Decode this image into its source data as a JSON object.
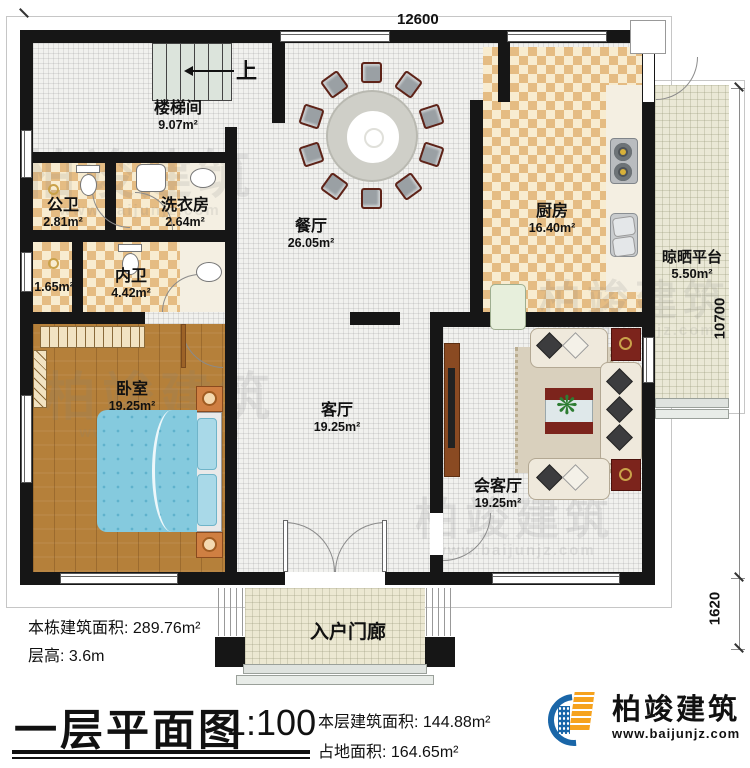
{
  "dimensions": {
    "top": "12600",
    "right": "10700",
    "bottom_right": "1620"
  },
  "stairs": {
    "up_label": "上"
  },
  "rooms": {
    "stairwell": {
      "name": "楼梯间",
      "area": "9.07m²"
    },
    "public_wc": {
      "name": "公卫",
      "area": "2.81m²"
    },
    "laundry": {
      "name": "洗衣房",
      "area": "2.64m²"
    },
    "closet": {
      "area": "1.65m²"
    },
    "private_wc": {
      "name": "内卫",
      "area": "4.42m²"
    },
    "bedroom": {
      "name": "卧室",
      "area": "19.25m²"
    },
    "dining": {
      "name": "餐厅",
      "area": "26.05m²"
    },
    "living": {
      "name": "客厅",
      "area": "19.25m²"
    },
    "kitchen": {
      "name": "厨房",
      "area": "16.40m²"
    },
    "reception": {
      "name": "会客厅",
      "area": "19.25m²"
    },
    "drying_platform": {
      "name": "晾晒平台",
      "area": "5.50m²"
    },
    "entrance_porch": {
      "name": "入户门廊"
    }
  },
  "annotations": {
    "building_total_area": "本栋建筑面积: 289.76m²",
    "floor_height": "层高: 3.6m",
    "floor_area": "本层建筑面积: 144.88m²",
    "land_area": "占地面积: 164.65m²"
  },
  "title_block": {
    "title": "一层平面图",
    "scale": "1:100"
  },
  "brand": {
    "name": "柏竣建筑",
    "website": "www.baijunjz.com"
  },
  "watermark": {
    "text": "柏竣建筑",
    "subtext": "www.baijunjz.com"
  }
}
